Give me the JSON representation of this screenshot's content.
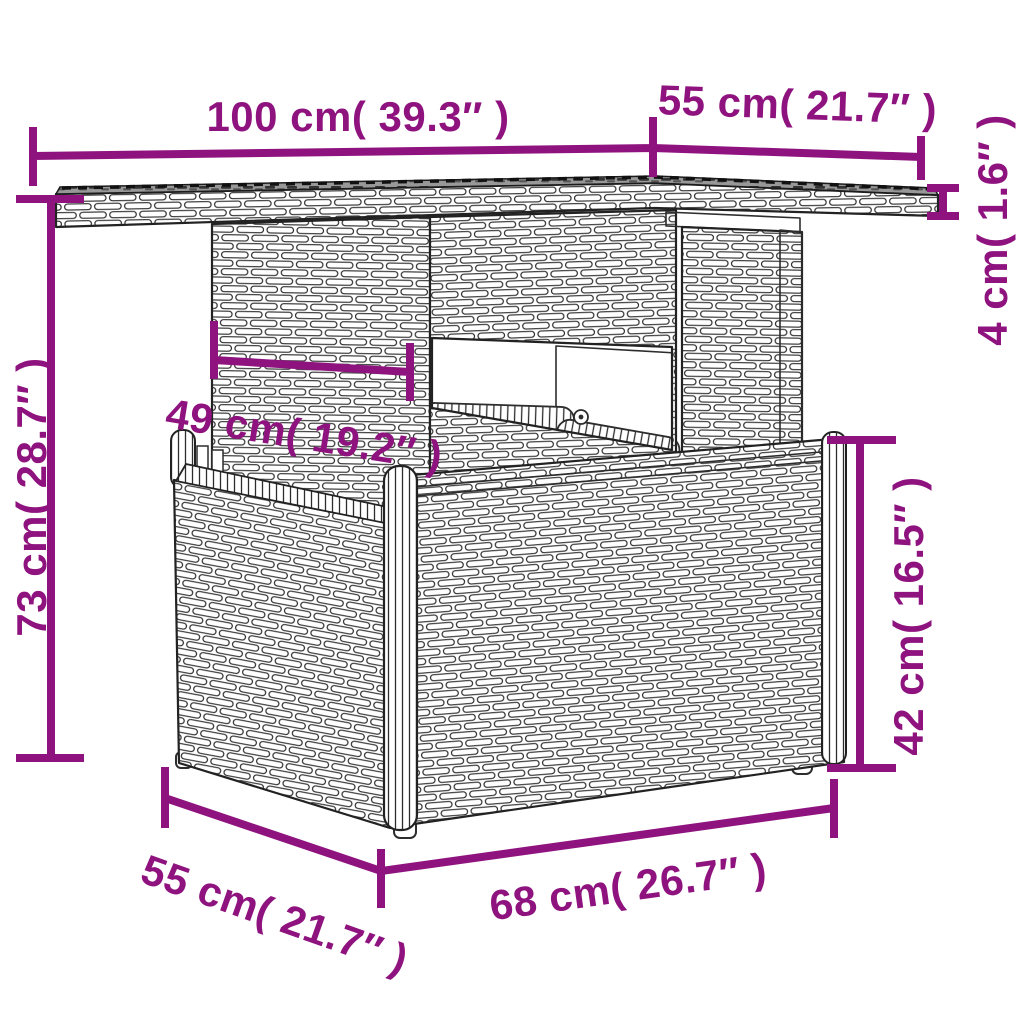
{
  "diagram": {
    "colors": {
      "dimension_accent": "#8F137F",
      "linework": "#2d2d2d",
      "glass_top": "#989898",
      "background": "#ffffff"
    },
    "dims": {
      "top_width": "100 cm( 39.3″ )",
      "top_depth": "55 cm( 21.7″ )",
      "top_thickness": "4 cm( 1.6″ )",
      "total_height": "73 cm( 28.7″ )",
      "column_width": "49 cm( 19.2″ )",
      "base_height": "42 cm( 16.5″ )",
      "base_depth": "55 cm( 21.7″ )",
      "base_width": "68 cm( 26.7″ )"
    }
  }
}
